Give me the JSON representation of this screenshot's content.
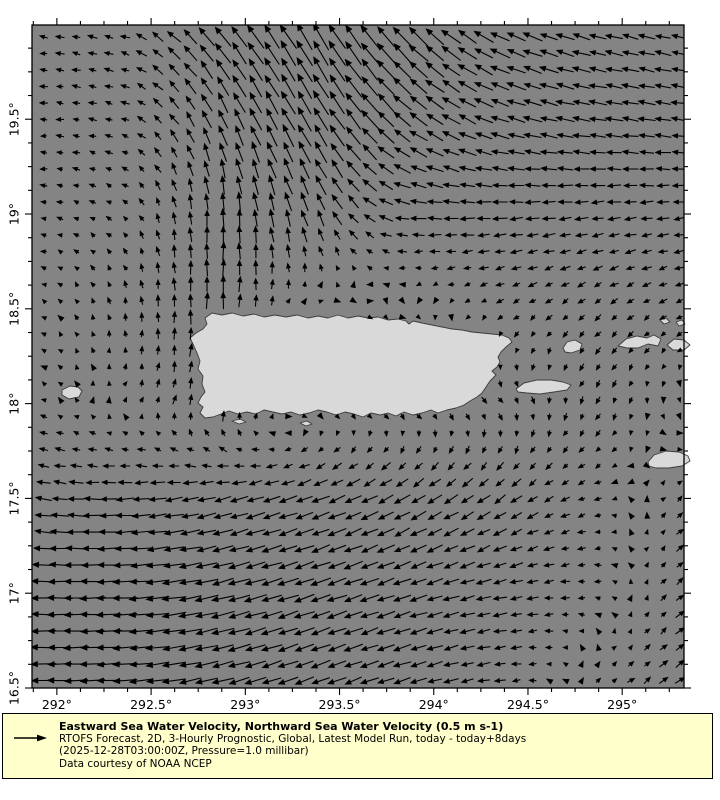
{
  "colors": {
    "ocean": "#848484",
    "land": "#d9d9d9",
    "coast": "#3c3c3c",
    "arrow": "#000000",
    "frame": "#000000",
    "legend_bg": "#ffffcc",
    "text": "#000000"
  },
  "legend": {
    "title": "Eastward Sea Water Velocity, Northward Sea Water Velocity (0.5 m s-1)",
    "lines": [
      "RTOFS Forecast, 2D, 3-Hourly Prognostic, Global, Latest Model Run, today - today+8days",
      "(2025-12-28T03:00:00Z, Pressure=1.0 millibar)",
      "Data courtesy of NOAA NCEP"
    ],
    "reference_speed_label": "0.5 m s-1"
  },
  "chart_data": {
    "type": "quiver",
    "title": "Eastward Sea Water Velocity, Northward Sea Water Velocity (0.5 m s-1)",
    "grid": "lon-lat",
    "lon_range": [
      291.868,
      295.328
    ],
    "lat_range": [
      16.5,
      19.997
    ],
    "reference_speed_ms": 0.5,
    "arrow_grid": {
      "cols": 40,
      "rows": 40
    },
    "x_axis": {
      "ticks": [
        {
          "value": 292.0,
          "label": "292°"
        },
        {
          "value": 292.5,
          "label": "292.5°"
        },
        {
          "value": 293.0,
          "label": "293°"
        },
        {
          "value": 293.5,
          "label": "293.5°"
        },
        {
          "value": 294.0,
          "label": "294°"
        },
        {
          "value": 294.5,
          "label": "294.5°"
        },
        {
          "value": 295.0,
          "label": "295°"
        }
      ],
      "minor_step": 0.125
    },
    "y_axis": {
      "ticks": [
        {
          "value": 16.5,
          "label": "16.5°"
        },
        {
          "value": 17.0,
          "label": "17°"
        },
        {
          "value": 17.5,
          "label": "17.5°"
        },
        {
          "value": 18.0,
          "label": "18°"
        },
        {
          "value": 18.5,
          "label": "18.5°"
        },
        {
          "value": 19.0,
          "label": "19°"
        },
        {
          "value": 19.5,
          "label": "19.5°"
        }
      ],
      "minor_step": 0.125
    },
    "flow_summary": [
      "northward jet west of Puerto Rico near 292.6E between 18N and 19.3N",
      "strong northwestward outflow at top centre 293-294E near 20N",
      "westward Atlantic drift across the north-east quadrant",
      "weak eastward countercurrent along the south coast near 18N",
      "strong westward Caribbean current south of 17.5N, strongest in the south-west",
      "northeastward inflow at the south-east corner near 295.2E"
    ],
    "control_field": {
      "lons": [
        291.87,
        292.37,
        292.87,
        293.37,
        293.87,
        294.37,
        294.87,
        295.37
      ],
      "lats": [
        16.5,
        17.0,
        17.5,
        18.0,
        18.5,
        19.0,
        19.5,
        20.0
      ],
      "u": [
        [
          -0.44,
          -0.42,
          -0.38,
          -0.32,
          -0.29,
          -0.18,
          0.08,
          0.18
        ],
        [
          -0.44,
          -0.44,
          -0.4,
          -0.35,
          -0.3,
          -0.24,
          -0.1,
          0.16
        ],
        [
          -0.26,
          -0.3,
          -0.3,
          -0.3,
          -0.26,
          -0.2,
          -0.11,
          0.12
        ],
        [
          -0.08,
          0.04,
          0.05,
          0.1,
          0.12,
          0.08,
          -0.06,
          0.04
        ],
        [
          -0.06,
          -0.02,
          0.01,
          0.06,
          0.04,
          -0.1,
          -0.1,
          -0.12
        ],
        [
          -0.1,
          -0.08,
          0.0,
          -0.12,
          -0.28,
          -0.25,
          -0.22,
          -0.2
        ],
        [
          -0.12,
          -0.13,
          -0.16,
          -0.25,
          -0.3,
          -0.32,
          -0.31,
          -0.28
        ],
        [
          -0.14,
          -0.16,
          -0.3,
          -0.28,
          -0.33,
          -0.34,
          -0.3,
          -0.26
        ]
      ],
      "v": [
        [
          0.0,
          -0.03,
          -0.1,
          -0.12,
          -0.09,
          -0.02,
          0.06,
          0.13
        ],
        [
          0.01,
          -0.02,
          -0.1,
          -0.12,
          -0.1,
          -0.05,
          0.01,
          0.12
        ],
        [
          0.05,
          -0.02,
          -0.08,
          -0.11,
          -0.15,
          -0.14,
          -0.03,
          0.1
        ],
        [
          0.03,
          0.06,
          0.22,
          -0.04,
          -0.07,
          -0.1,
          -0.12,
          -0.05
        ],
        [
          0.02,
          0.12,
          0.3,
          -0.02,
          -0.03,
          -0.06,
          -0.09,
          -0.05
        ],
        [
          0.01,
          0.06,
          0.32,
          0.3,
          0.02,
          -0.02,
          -0.03,
          -0.02
        ],
        [
          0.0,
          0.04,
          0.34,
          0.42,
          0.24,
          0.1,
          0.05,
          0.04
        ],
        [
          0.02,
          0.05,
          0.35,
          0.48,
          0.35,
          0.16,
          0.08,
          0.06
        ]
      ]
    },
    "islands": [
      {
        "name": "puerto-rico",
        "points_px": [
          [
            212,
            313
          ],
          [
            222,
            315
          ],
          [
            232,
            313
          ],
          [
            243,
            316
          ],
          [
            254,
            314
          ],
          [
            264,
            317
          ],
          [
            275,
            315
          ],
          [
            286,
            317
          ],
          [
            297,
            315
          ],
          [
            308,
            318
          ],
          [
            318,
            316
          ],
          [
            328,
            318
          ],
          [
            338,
            315
          ],
          [
            348,
            318
          ],
          [
            358,
            316
          ],
          [
            368,
            318
          ],
          [
            378,
            317
          ],
          [
            388,
            320
          ],
          [
            398,
            319
          ],
          [
            406,
            321
          ],
          [
            409,
            324
          ],
          [
            413,
            321
          ],
          [
            422,
            323
          ],
          [
            432,
            325
          ],
          [
            442,
            327
          ],
          [
            452,
            329
          ],
          [
            462,
            330
          ],
          [
            472,
            332
          ],
          [
            482,
            333
          ],
          [
            492,
            334
          ],
          [
            502,
            335
          ],
          [
            509,
            338
          ],
          [
            512,
            342
          ],
          [
            506,
            347
          ],
          [
            501,
            352
          ],
          [
            498,
            357
          ],
          [
            500,
            362
          ],
          [
            497,
            367
          ],
          [
            492,
            371
          ],
          [
            496,
            375
          ],
          [
            490,
            381
          ],
          [
            486,
            387
          ],
          [
            482,
            393
          ],
          [
            477,
            397
          ],
          [
            470,
            401
          ],
          [
            464,
            405
          ],
          [
            456,
            408
          ],
          [
            447,
            410
          ],
          [
            438,
            413
          ],
          [
            431,
            410
          ],
          [
            422,
            413
          ],
          [
            413,
            415
          ],
          [
            404,
            412
          ],
          [
            396,
            416
          ],
          [
            388,
            413
          ],
          [
            380,
            415
          ],
          [
            371,
            413
          ],
          [
            363,
            417
          ],
          [
            354,
            414
          ],
          [
            345,
            412
          ],
          [
            336,
            415
          ],
          [
            327,
            412
          ],
          [
            318,
            410
          ],
          [
            309,
            413
          ],
          [
            300,
            415
          ],
          [
            291,
            412
          ],
          [
            282,
            414
          ],
          [
            273,
            412
          ],
          [
            264,
            410
          ],
          [
            256,
            414
          ],
          [
            247,
            412
          ],
          [
            238,
            414
          ],
          [
            229,
            411
          ],
          [
            221,
            414
          ],
          [
            213,
            417
          ],
          [
            205,
            418
          ],
          [
            200,
            413
          ],
          [
            203,
            407
          ],
          [
            198,
            403
          ],
          [
            201,
            397
          ],
          [
            205,
            392
          ],
          [
            202,
            384
          ],
          [
            203,
            376
          ],
          [
            198,
            369
          ],
          [
            200,
            361
          ],
          [
            197,
            353
          ],
          [
            193,
            344
          ],
          [
            190,
            338
          ],
          [
            196,
            333
          ],
          [
            203,
            329
          ],
          [
            207,
            324
          ],
          [
            205,
            318
          ]
        ]
      },
      {
        "name": "mona-island",
        "points_px": [
          [
            62,
            390
          ],
          [
            70,
            386
          ],
          [
            78,
            387
          ],
          [
            82,
            391
          ],
          [
            79,
            397
          ],
          [
            69,
            399
          ],
          [
            62,
            395
          ]
        ]
      },
      {
        "name": "vieques",
        "points_px": [
          [
            516,
            389
          ],
          [
            524,
            383
          ],
          [
            537,
            380
          ],
          [
            551,
            380
          ],
          [
            563,
            382
          ],
          [
            571,
            385
          ],
          [
            567,
            390
          ],
          [
            554,
            392
          ],
          [
            540,
            394
          ],
          [
            527,
            393
          ],
          [
            518,
            392
          ]
        ]
      },
      {
        "name": "culebra",
        "points_px": [
          [
            563,
            348
          ],
          [
            567,
            342
          ],
          [
            575,
            340
          ],
          [
            582,
            344
          ],
          [
            580,
            350
          ],
          [
            571,
            353
          ],
          [
            565,
            352
          ]
        ]
      },
      {
        "name": "st-thomas",
        "points_px": [
          [
            618,
            346
          ],
          [
            626,
            339
          ],
          [
            637,
            336
          ],
          [
            647,
            338
          ],
          [
            654,
            335
          ],
          [
            661,
            339
          ],
          [
            658,
            346
          ],
          [
            648,
            344
          ],
          [
            638,
            348
          ],
          [
            627,
            348
          ]
        ]
      },
      {
        "name": "st-john-tortola",
        "points_px": [
          [
            667,
            345
          ],
          [
            674,
            339
          ],
          [
            684,
            340
          ],
          [
            690,
            345
          ],
          [
            684,
            350
          ],
          [
            673,
            350
          ]
        ]
      },
      {
        "name": "virgin-islet-a",
        "points_px": [
          [
            660,
            320
          ],
          [
            666,
            318
          ],
          [
            670,
            322
          ],
          [
            664,
            324
          ]
        ]
      },
      {
        "name": "virgin-islet-b",
        "points_px": [
          [
            676,
            322
          ],
          [
            682,
            320
          ],
          [
            685,
            324
          ],
          [
            679,
            326
          ]
        ]
      },
      {
        "name": "st-croix",
        "points_px": [
          [
            648,
            462
          ],
          [
            654,
            455
          ],
          [
            666,
            451
          ],
          [
            679,
            452
          ],
          [
            688,
            456
          ],
          [
            690,
            461
          ],
          [
            682,
            466
          ],
          [
            669,
            468
          ],
          [
            656,
            468
          ],
          [
            649,
            466
          ]
        ]
      },
      {
        "name": "south-cay-a",
        "points_px": [
          [
            232,
            421
          ],
          [
            240,
            419
          ],
          [
            246,
            422
          ],
          [
            239,
            424
          ]
        ]
      },
      {
        "name": "south-cay-b",
        "points_px": [
          [
            300,
            423
          ],
          [
            307,
            421
          ],
          [
            312,
            424
          ],
          [
            306,
            426
          ]
        ]
      }
    ]
  }
}
